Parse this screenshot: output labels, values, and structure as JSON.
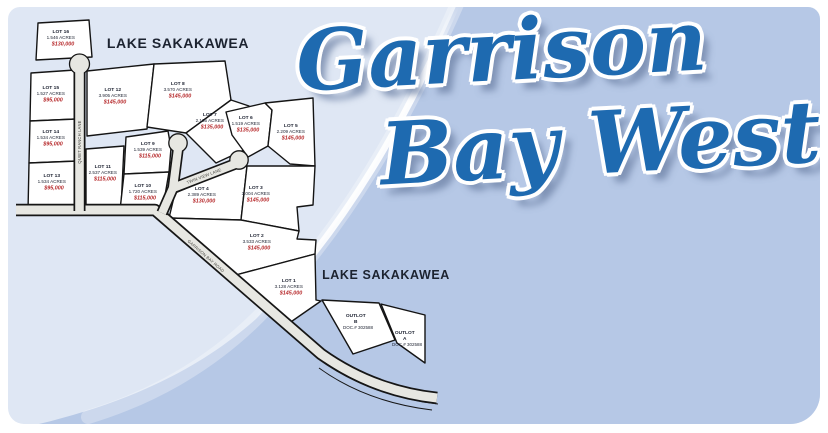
{
  "title": {
    "line1": "Garrison",
    "line2": "Bay West"
  },
  "water_labels": {
    "top": "LAKE SAKAKAWEA",
    "middle": "LAKE SAKAKAWEA"
  },
  "roads": [
    {
      "name": "QUIET RANCH LANE"
    },
    {
      "name": "TWIN VIEW LANE"
    },
    {
      "name": "GARRISON BAY ROAD"
    }
  ],
  "lots": [
    {
      "name": "LOT 16",
      "acres": "1.546 ACRES",
      "price": "$130,000"
    },
    {
      "name": "LOT 15",
      "acres": "1.527 ACRES",
      "price": "$95,000"
    },
    {
      "name": "LOT 14",
      "acres": "1.534 ACRES",
      "price": "$95,000"
    },
    {
      "name": "LOT 13",
      "acres": "1.534 ACRES",
      "price": "$95,000"
    },
    {
      "name": "LOT 12",
      "acres": "3.905 ACRES",
      "price": "$145,000"
    },
    {
      "name": "LOT 11",
      "acres": "2.537 ACRES",
      "price": "$115,000"
    },
    {
      "name": "LOT 9",
      "acres": "1.539 ACRES",
      "price": "$115,000"
    },
    {
      "name": "LOT 10",
      "acres": "1.720 ACRES",
      "price": "$115,000"
    },
    {
      "name": "LOT 8",
      "acres": "3.570 ACRES",
      "price": "$145,000"
    },
    {
      "name": "LOT 7",
      "acres": "2.165 ACRES",
      "price": "$135,000"
    },
    {
      "name": "LOT 6",
      "acres": "1.519 ACRES",
      "price": "$135,000"
    },
    {
      "name": "LOT 5",
      "acres": "2.209 ACRES",
      "price": "$145,000"
    },
    {
      "name": "LOT 4",
      "acres": "2.389 ACRES",
      "price": "$130,000"
    },
    {
      "name": "LOT 3",
      "acres": "3.004 ACRES",
      "price": "$145,000"
    },
    {
      "name": "LOT 2",
      "acres": "3.533 ACRES",
      "price": "$145,000"
    },
    {
      "name": "LOT 1",
      "acres": "3.128 ACRES",
      "price": "$145,000"
    }
  ],
  "outlots": [
    {
      "name": "OUTLOT",
      "letter": "B",
      "doc": "DOC.# 302588"
    },
    {
      "name": "OUTLOT",
      "letter": "A",
      "doc": "DOC.# 302588"
    }
  ],
  "colors": {
    "title_blue": "#1e6ab0",
    "price_red": "#b6292b",
    "label_dark": "#1c2130",
    "bg_light": "#dfe7f4",
    "bg_medium": "#b6c8e6",
    "road_fill": "#e7e7e2"
  }
}
